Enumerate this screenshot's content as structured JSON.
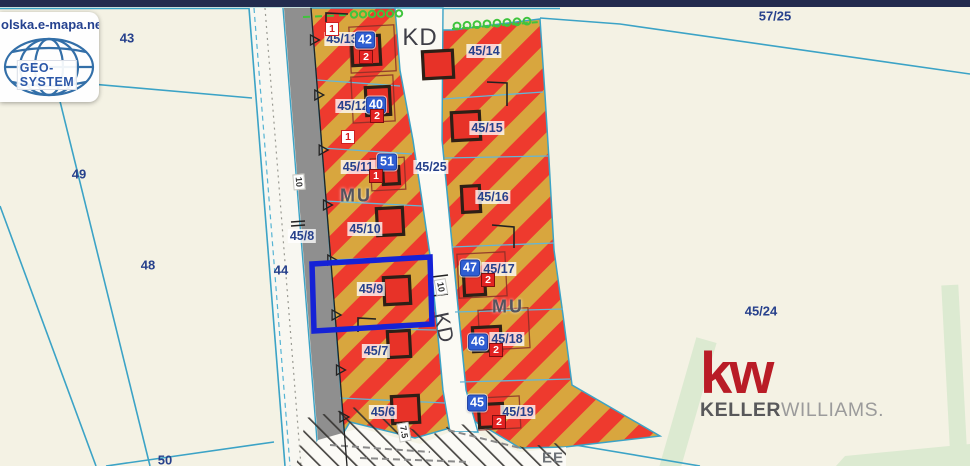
{
  "watermark": {
    "site_text": "olska.e-mapa.net",
    "logo_text": "GEO-SYSTEM"
  },
  "branding": {
    "monogram": "kw",
    "name_bold": "KELLER",
    "name_light": "WILLIAMS."
  },
  "zone_labels": {
    "mu_left": "MU",
    "mu_right": "MU",
    "kd_top": "KD",
    "kd_road": "KD",
    "ee": "EE"
  },
  "dim_labels": {
    "w10_left": "10",
    "w10_right": "10",
    "w75": "7.5"
  },
  "parcel_labels": {
    "p43": "43",
    "p48": "48",
    "p49": "49",
    "p50": "50",
    "p44": "44",
    "p57_25": "57/25",
    "p45_24": "45/24",
    "p45_8": "45/8",
    "p45_25": "45/25",
    "p45_6": "45/6",
    "p45_7": "45/7",
    "p45_9": "45/9",
    "p45_10": "45/10",
    "p45_11": "45/11",
    "p45_12": "45/12",
    "p45_13": "45/13",
    "p45_14": "45/14",
    "p45_15": "45/15",
    "p45_16": "45/16",
    "p45_17": "45/17",
    "p45_18": "45/18",
    "p45_19": "45/19"
  },
  "address_badges": {
    "b42": "42",
    "b40": "40",
    "b51": "51",
    "b47": "47",
    "b46": "46",
    "b45": "45"
  },
  "house_numbers": {
    "n1_4513": "1",
    "n2_4513": "2",
    "n1_4512": "1",
    "n2_4512": "2",
    "n1_4511": "1",
    "n2_4517": "2",
    "n2_4518": "2",
    "n2_4519": "2"
  },
  "colors": {
    "stripe_red": "#ee3a2e",
    "stripe_gold": "#d8a63e",
    "selection_blue": "#1522d6",
    "boundary_cyan": "#3ba3c6",
    "label_navy": "#27418c",
    "road_gray": "#8f8f8f",
    "top_bar_navy": "#232b4e",
    "kw_red": "#b91c26",
    "symbol_lime": "#3fc43c",
    "green_band": "#dcead1",
    "background_cream": "#f4f2e4"
  }
}
